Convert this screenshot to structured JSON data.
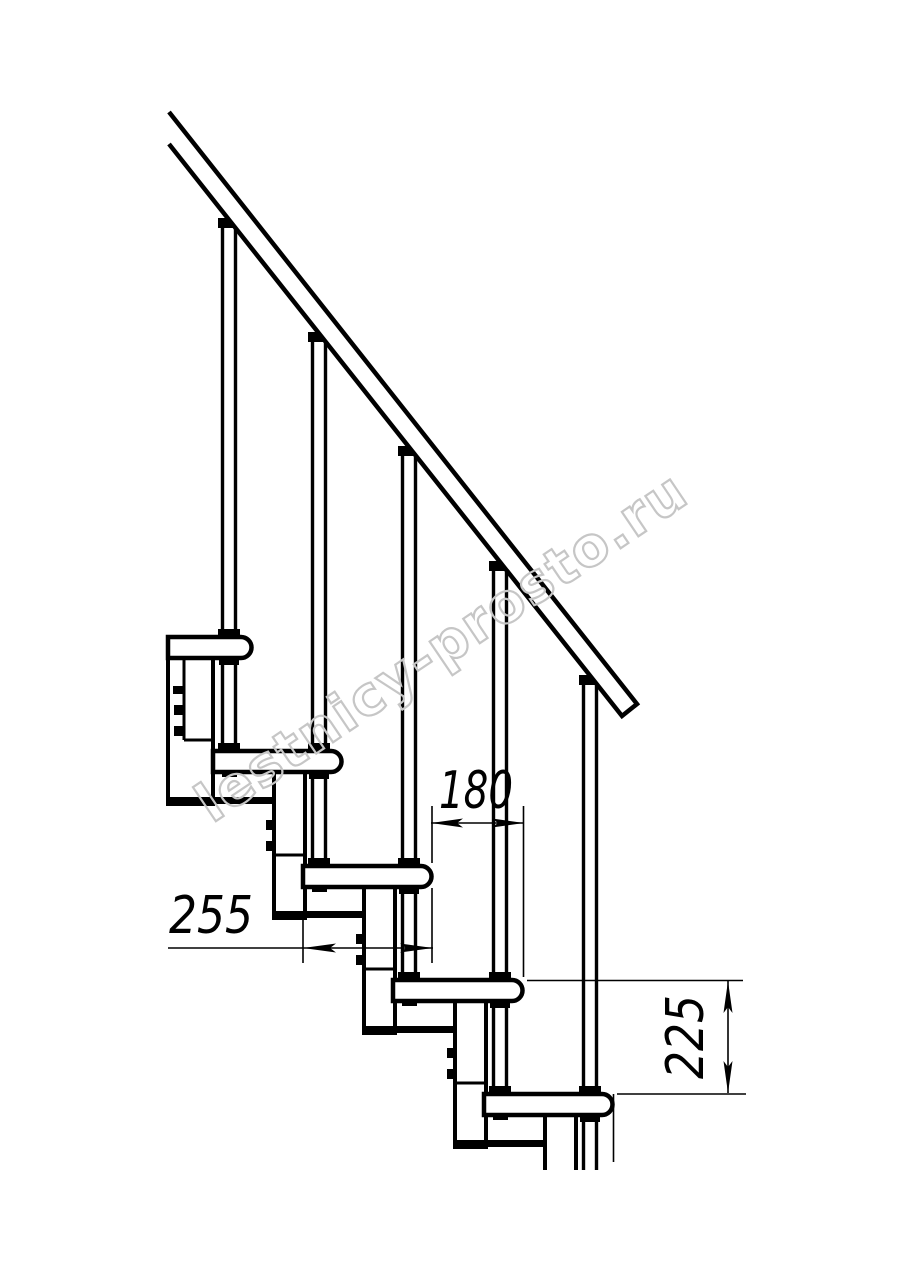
{
  "drawing": {
    "subject": "modular staircase side-view technical drawing",
    "units": "mm",
    "line_color": "#000000",
    "background_color": "#ffffff",
    "tread_count_visible": 5
  },
  "dimensions": {
    "step_run": {
      "value": "180",
      "meaning": "horizontal run between consecutive treads"
    },
    "tread_depth": {
      "value": "255",
      "meaning": "tread depth"
    },
    "step_rise": {
      "value": "225",
      "meaning": "vertical rise between treads"
    }
  },
  "watermark": {
    "text": "lestnicy-prosto.ru",
    "color": "#c6c6c6"
  }
}
